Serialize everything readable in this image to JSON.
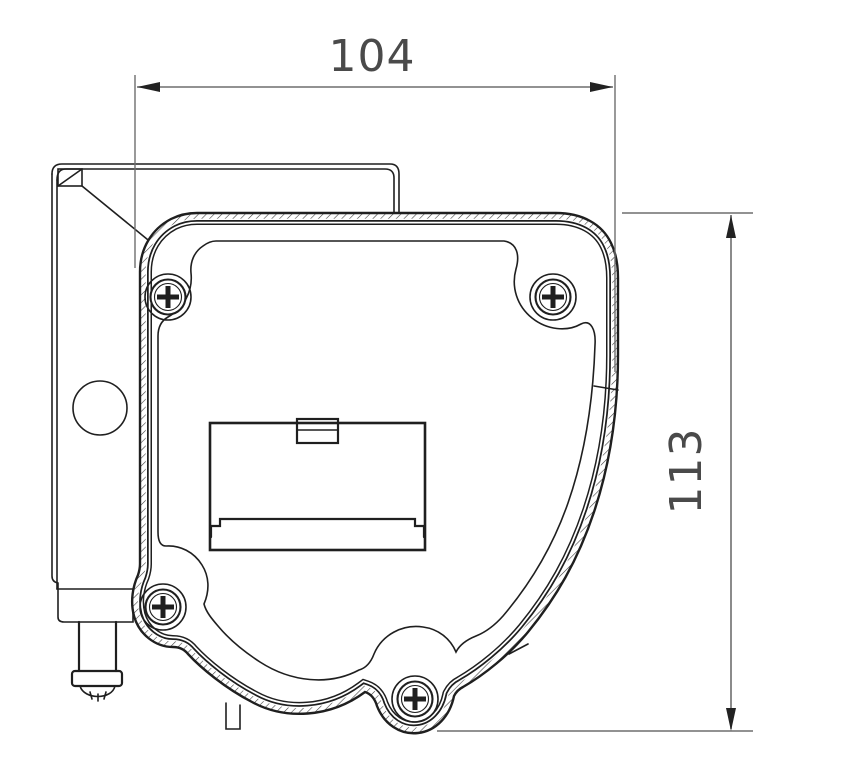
{
  "drawing": {
    "type": "technical-drawing",
    "view": "awning cassette end bracket - side profile",
    "dim_width": "104",
    "dim_height": "113",
    "colors": {
      "line": "#1f1f1f",
      "dimension": "#6e6e6e",
      "background": "#ffffff",
      "text": "#4a4a4a"
    }
  }
}
